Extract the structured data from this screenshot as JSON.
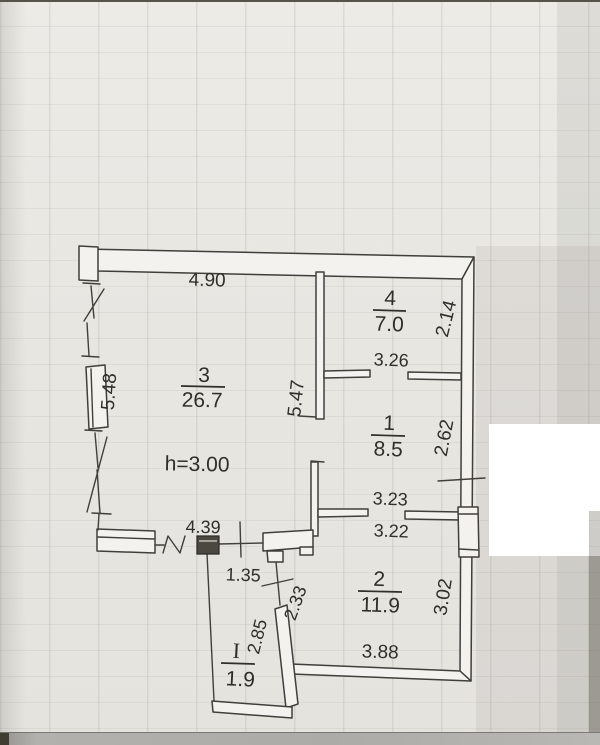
{
  "plan": {
    "ceiling_height": "h=3.00",
    "rooms": [
      {
        "number": "3",
        "area": "26.7"
      },
      {
        "number": "4",
        "area": "7.0"
      },
      {
        "number": "1",
        "area": "8.5"
      },
      {
        "number": "2",
        "area": "11.9"
      },
      {
        "number": "I",
        "area": "1.9"
      }
    ],
    "dims": {
      "top": "4.90",
      "left": "5.48",
      "inner": "5.47",
      "r4_side": "2.14",
      "r4_bottom": "3.26",
      "r1_side": "2.62",
      "r1_wall_top": "3.23",
      "r1_wall_bottom": "3.22",
      "r2_side": "3.02",
      "r2_bottom": "3.88",
      "hall": "4.39",
      "gap": "1.35",
      "loggia_side": "2.33",
      "loggia_wall": "2.85"
    },
    "colors": {
      "paper": "#e8e6e1",
      "ink": "#3c3a35",
      "wall_fill": "#f3f2ee",
      "redaction": "#ffffff"
    }
  }
}
